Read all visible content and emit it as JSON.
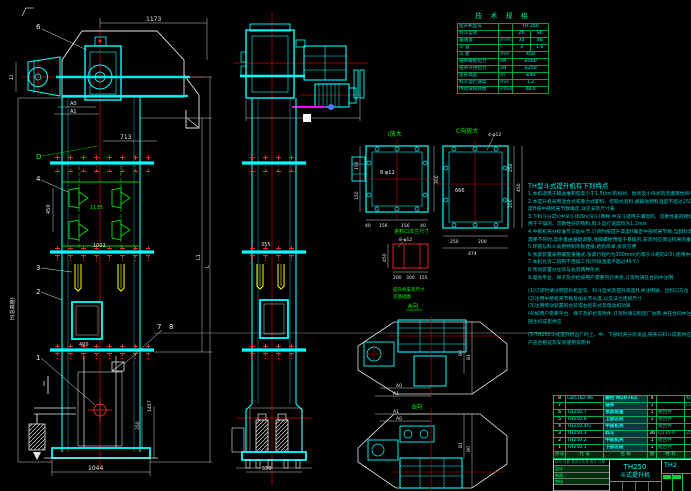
{
  "drawing": {
    "model": "TH250",
    "product": "斗式提升机"
  },
  "dims": {
    "d1173": "1173",
    "dA0": "A0",
    "dA1": "A1",
    "d713": "713",
    "d450": "450",
    "d1135": "1135",
    "d1002": "1002",
    "d400": "400",
    "d350": "350",
    "d1457": "1457",
    "d1044": "1044",
    "d12": "12",
    "dH": "H(总高度)",
    "dL": "L",
    "dL1": "L1",
    "d355": "355",
    "d550": "550",
    "i_bolt": "8-φ12",
    "i_40a": "40",
    "i_156a": "156",
    "i_156b": "156",
    "i_40b": "40",
    "i_150a": "150",
    "i_150b": "150",
    "i_300": "300",
    "c_bolt": "4-φ12",
    "c_inner": "666",
    "c_250a": "250",
    "c_200a": "200",
    "c_474": "474",
    "c_250b": "250",
    "c_200b": "200",
    "c_450": "450",
    "f_bolt": "8-φ12",
    "f_200": "200",
    "f_300": "300",
    "f_155": "155",
    "f_450": "450",
    "pa_A0": "A0",
    "pa_A1": "A1",
    "pa_B0": "B0",
    "pa_B1": "B1",
    "pb_A0": "A0",
    "pb_A1": "A1",
    "pb_B0": "B0",
    "pb_B1": "B1"
  },
  "callouts": {
    "n1": "1",
    "n2": "2",
    "n3": "3",
    "n4": "4",
    "n6": "6",
    "n7": "7",
    "n8": "8",
    "nD": "D",
    "nI": "I"
  },
  "view_labels": {
    "detail_i": "I放大",
    "view_c": "C向放大",
    "plan_a": "A向",
    "plan_b": "B向",
    "feed_flange": "进料口法兰尺寸",
    "install_1": "提升机安装尺寸",
    "install_2": "见基础图"
  },
  "spec_table": {
    "title": "技 术 规 格",
    "rows": [
      {
        "label": "提升机型号",
        "unit": "",
        "v1": "TH 250",
        "v2": ""
      },
      {
        "label": "料斗型式",
        "unit": "",
        "v1": "Zh",
        "v2": "Sh"
      },
      {
        "label": "输送量",
        "unit": "m³/h",
        "v1": "35",
        "v2": "48"
      },
      {
        "label": "斗  容",
        "unit": "l",
        "v1": "3",
        "v2": "1.6"
      },
      {
        "label": "斗  距",
        "unit": "mm",
        "v1": "450",
        "v2": ""
      },
      {
        "label": "链条破断拉力",
        "unit": "kN",
        "v1": "≥560",
        "v2": ""
      },
      {
        "label": "链条许用拉力",
        "unit": "kN",
        "v1": "≥250",
        "v2": ""
      },
      {
        "label": "提升高度",
        "unit": "m",
        "v1": "≤40",
        "v2": ""
      },
      {
        "label": "料斗运行速度",
        "unit": "m/s",
        "v1": "1.2",
        "v2": ""
      },
      {
        "label": "传动滚筒转数",
        "unit": "r/min",
        "v1": "48.0",
        "v2": ""
      }
    ]
  },
  "notes": {
    "title": "TH型斗式提升机有下列特点",
    "lines": [
      "1.本机适用于输送堆积密度小于1.5t/m³的粉状、粒状及小块状的无磨琢性和半磨琢性物料",
      "2.本提升机采用混合式或重力式卸料、挖取式装料,被输送物料温度不超过250℃,提升高",
      "  度H按中部机壳节数确定,详见安装尺寸表",
      "3.下料斗分Zh(中深斗)和Sh(深斗)两种,中深斗适用于潮湿的、流散性差的物料,深斗适",
      "  用于干燥的、流散性好的物料,料斗运行速度均为1.2m/s",
      "4.中部机壳分标准节与加长节,订货时按提升高度H确定中部机壳节数,当卸料高度与实际",
      "  需要不符时,其余量由基础调整,地脚螺栓预埋于基础内,安装时应保证机壳的垂直度",
      "5.环链与料斗采用特制弯板连接,结构简单,拆装方便",
      "6.张紧装置采用螺旋重锤式,张紧行程约为300mm(约等于斗距的2/3),使用中应定期检查",
      "7.本机允许二班制不连续工作(环境温度不超过40℃)",
      "8.传动装置分左装与右装两种形式",
      "9.驱动平台、梯子及护栏按用户需要另行供货,订货时请在合同中注明",
      "(1)订货时请注明提升机型号、料斗型式及提升高度H,并注明进、出料口方位",
      "(2)注明中部机壳节数及加长节长度,以及法兰连接尺寸",
      "(3)注明传动装置的左装或右装形式及电动机功率",
      "(4)如用户需要平台、梯子及护栏等附件,订货时请与制造厂协商,并在合同中注明,附件",
      "  随主机成套供应",
      "(5)TH250斗式提升机出厂时上、中、下部机壳分装发运,链条与料斗成套供应,随机供应",
      "  产品合格证及安装使用说明书"
    ]
  },
  "parts_table": {
    "header": [
      "序号",
      "代  号",
      "名  称",
      "数",
      "材 料",
      "备  注"
    ],
    "rows": [
      {
        "no": "8",
        "code": "GB5782-86",
        "name": "螺栓 M20×65",
        "qty": "4",
        "mat": "",
        "rem": "标准件"
      },
      {
        "no": "7",
        "code": "",
        "name": "链条",
        "qty": "1",
        "mat": "",
        "rem": "L="
      },
      {
        "no": "6",
        "code": "TH250.7",
        "name": "张紧装置",
        "qty": "1",
        "mat": "组合件",
        "rem": ""
      },
      {
        "no": "5",
        "code": "TH250.6",
        "name": "上部区段",
        "qty": "1",
        "mat": "组合件",
        "rem": ""
      },
      {
        "no": "4",
        "code": "TH250.4/5",
        "name": "中部机壳",
        "qty": "",
        "mat": "组合件",
        "rem": ""
      },
      {
        "no": "3",
        "code": "TH250.3",
        "name": "料斗",
        "qty": "36",
        "mat": "Q235-A",
        "rem": "205"
      },
      {
        "no": "2",
        "code": "TH250.2",
        "name": "中部机壳",
        "qty": "1",
        "mat": "组合件",
        "rem": ""
      },
      {
        "no": "1",
        "code": "TH250.1",
        "name": "下部区段",
        "qty": "1",
        "mat": "组合件",
        "rem": ""
      }
    ]
  },
  "title_block": {
    "model": "TH250",
    "name": "斗式提升机",
    "drawing_no": "TH2",
    "rev_header": "标记 处数 更改文件号 签字 日期",
    "sign_labels": [
      "设计",
      "制图",
      "审核"
    ]
  }
}
